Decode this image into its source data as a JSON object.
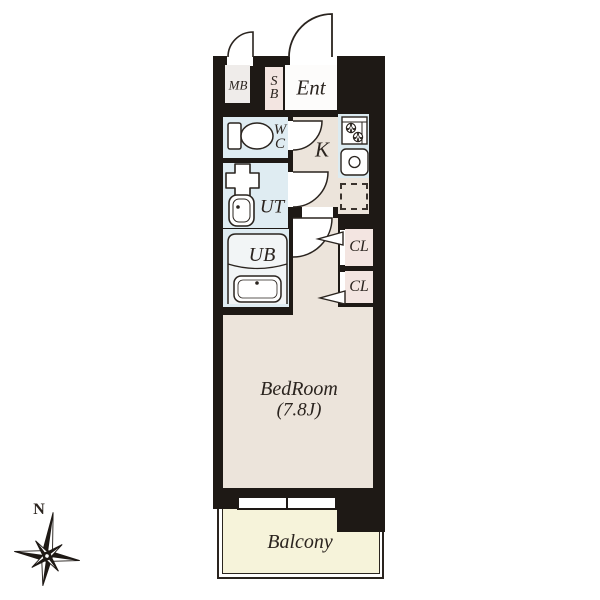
{
  "floorplan": {
    "rooms": {
      "mb": {
        "label": "MB"
      },
      "sb": {
        "lines": [
          "S",
          "B"
        ]
      },
      "ent": {
        "label": "Ent"
      },
      "wc": {
        "lines": [
          "W",
          "C"
        ]
      },
      "kitchen": {
        "label": "K"
      },
      "ut": {
        "label": "UT"
      },
      "ub": {
        "label": "UB"
      },
      "cl1": {
        "label": "CL"
      },
      "cl2": {
        "label": "CL"
      },
      "bedroom": {
        "name": "BedRoom",
        "size": "(7.8J)"
      },
      "balcony": {
        "label": "Balcony"
      }
    },
    "compass": {
      "label": "N"
    },
    "colors": {
      "wall": "#1e1915",
      "floor_beige": "#ece4db",
      "wet_area_blue": "#dfecf2",
      "closet_pink": "#f3e5e1",
      "balcony_yellow": "#f6f3da",
      "meter_box_gray": "#efecea",
      "entry_white": "#fdfcfb",
      "line": "#2a241f"
    },
    "icons": [
      "toilet-icon",
      "washer-pan-icon",
      "utility-sink-icon",
      "bathtub-icon",
      "stove-icon",
      "kitchen-sink-icon",
      "refrigerator-dashed-outline",
      "door-swing-arc",
      "folding-door-marker",
      "compass-rose-icon"
    ]
  }
}
